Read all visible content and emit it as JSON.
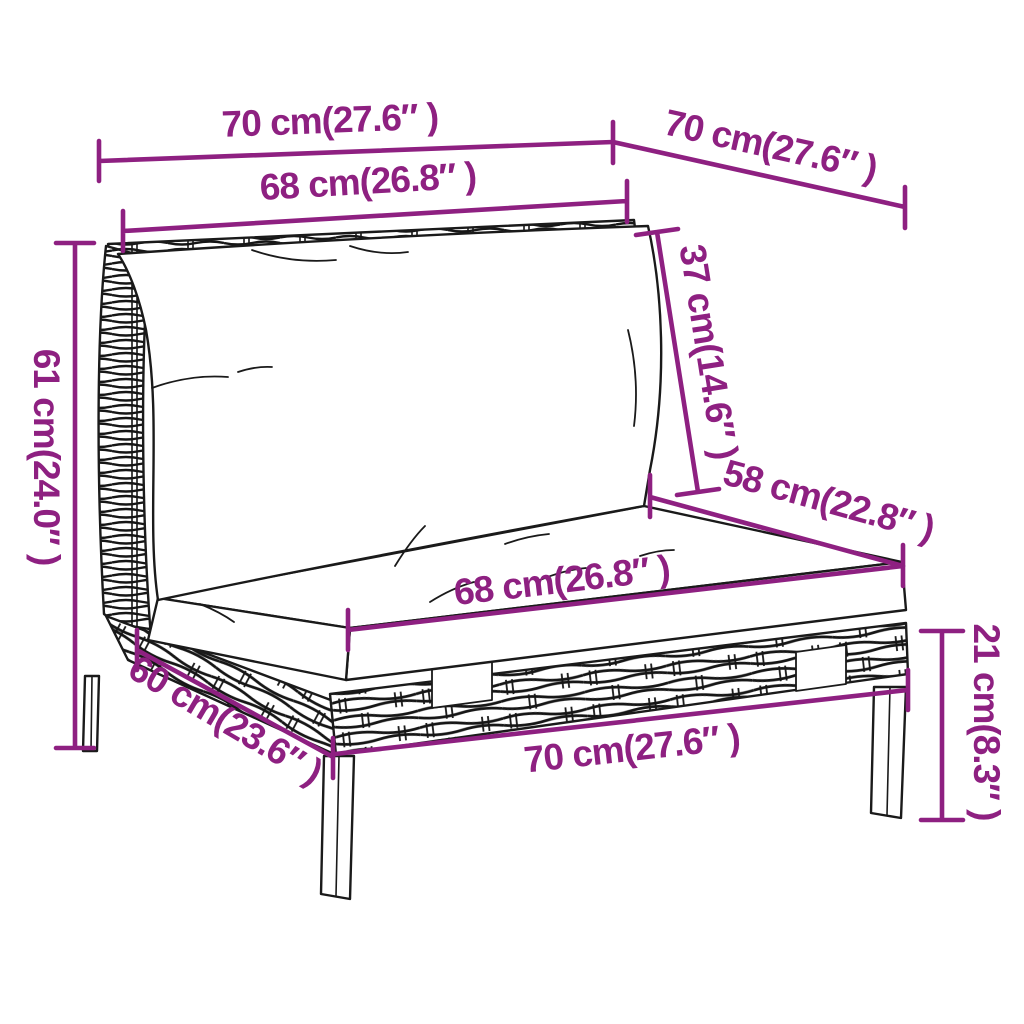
{
  "diagram": {
    "kind": "product-dimension-diagram",
    "subject": "rattan-garden-sofa-middle-section-with-cushions",
    "background_color": "#ffffff",
    "outline_color": "#1a1a1a",
    "accent_color": "#8e2081",
    "dimensions": [
      {
        "id": "top-width",
        "label": "70 cm(27.6″ )"
      },
      {
        "id": "top-depth",
        "label": "70 cm(27.6″ )"
      },
      {
        "id": "back-cushion-width",
        "label": "68 cm(26.8″ )"
      },
      {
        "id": "back-cushion-height",
        "label": "37 cm(14.6″ )"
      },
      {
        "id": "seat-depth",
        "label": "58 cm(22.8″ )"
      },
      {
        "id": "seat-cushion-width",
        "label": "68 cm(26.8″ )"
      },
      {
        "id": "total-height",
        "label": "61 cm(24.0″ )"
      },
      {
        "id": "base-depth",
        "label": "60 cm(23.6″ )"
      },
      {
        "id": "base-width",
        "label": "70 cm(27.6″ )"
      },
      {
        "id": "leg-height",
        "label": "21 cm(8.3″ )"
      }
    ]
  }
}
